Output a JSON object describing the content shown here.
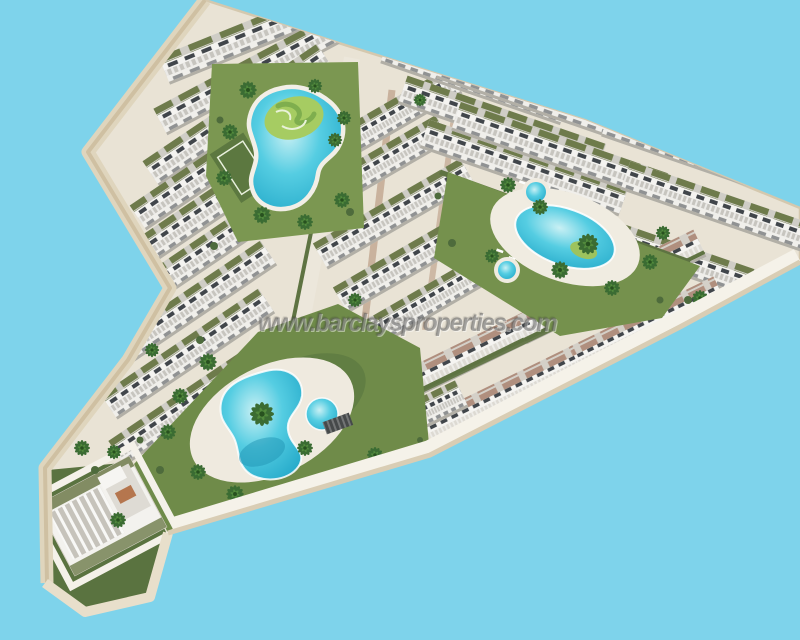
{
  "scene": {
    "type": "3d-aerial-render",
    "subject": "Bird's-eye 3D architectural render of a white Mediterranean residential complex shaped like a boomerang, with terraced apartment blocks, green roofs, communal pools, lawns and palm trees on a plain light-blue background",
    "background_color": "#7ed3eb"
  },
  "watermark": {
    "text": "www.barclaysproperties.com"
  },
  "palette": {
    "sky_blue": "#7ed3eb",
    "plot_base": "#e9e3d5",
    "walkway_white": "#f5f2e9",
    "wall_beige": "#dfd5bd",
    "building_white": "#f2f1ed",
    "building_shadow": "#c2c0ba",
    "window_dark": "#41464b",
    "roof_green": "#6e7b4b",
    "lawn_green": "#6f8b49",
    "island_green": "#a6cc62",
    "pool_turquoise": "#3cc0d8",
    "terracotta_deck": "#b08f7e",
    "palm_green": "#3b6c33"
  },
  "features": {
    "lagoon_pool": "Lagoon-style pool wrapping a landscaped green island (north courtyard)",
    "oval_pool": "Oval community pool with palm island (east courtyard)",
    "kidney_pool": "Free-form pool in the south-west garden",
    "spa_pools": "Small circular spa pools beside the east pool",
    "apartment_wings": "Stepped rows of white apartment blocks with planted roofs",
    "detached_block": "Detached apartment block at the south-west tip",
    "sports_court": "Small sports court on the north lawn"
  }
}
